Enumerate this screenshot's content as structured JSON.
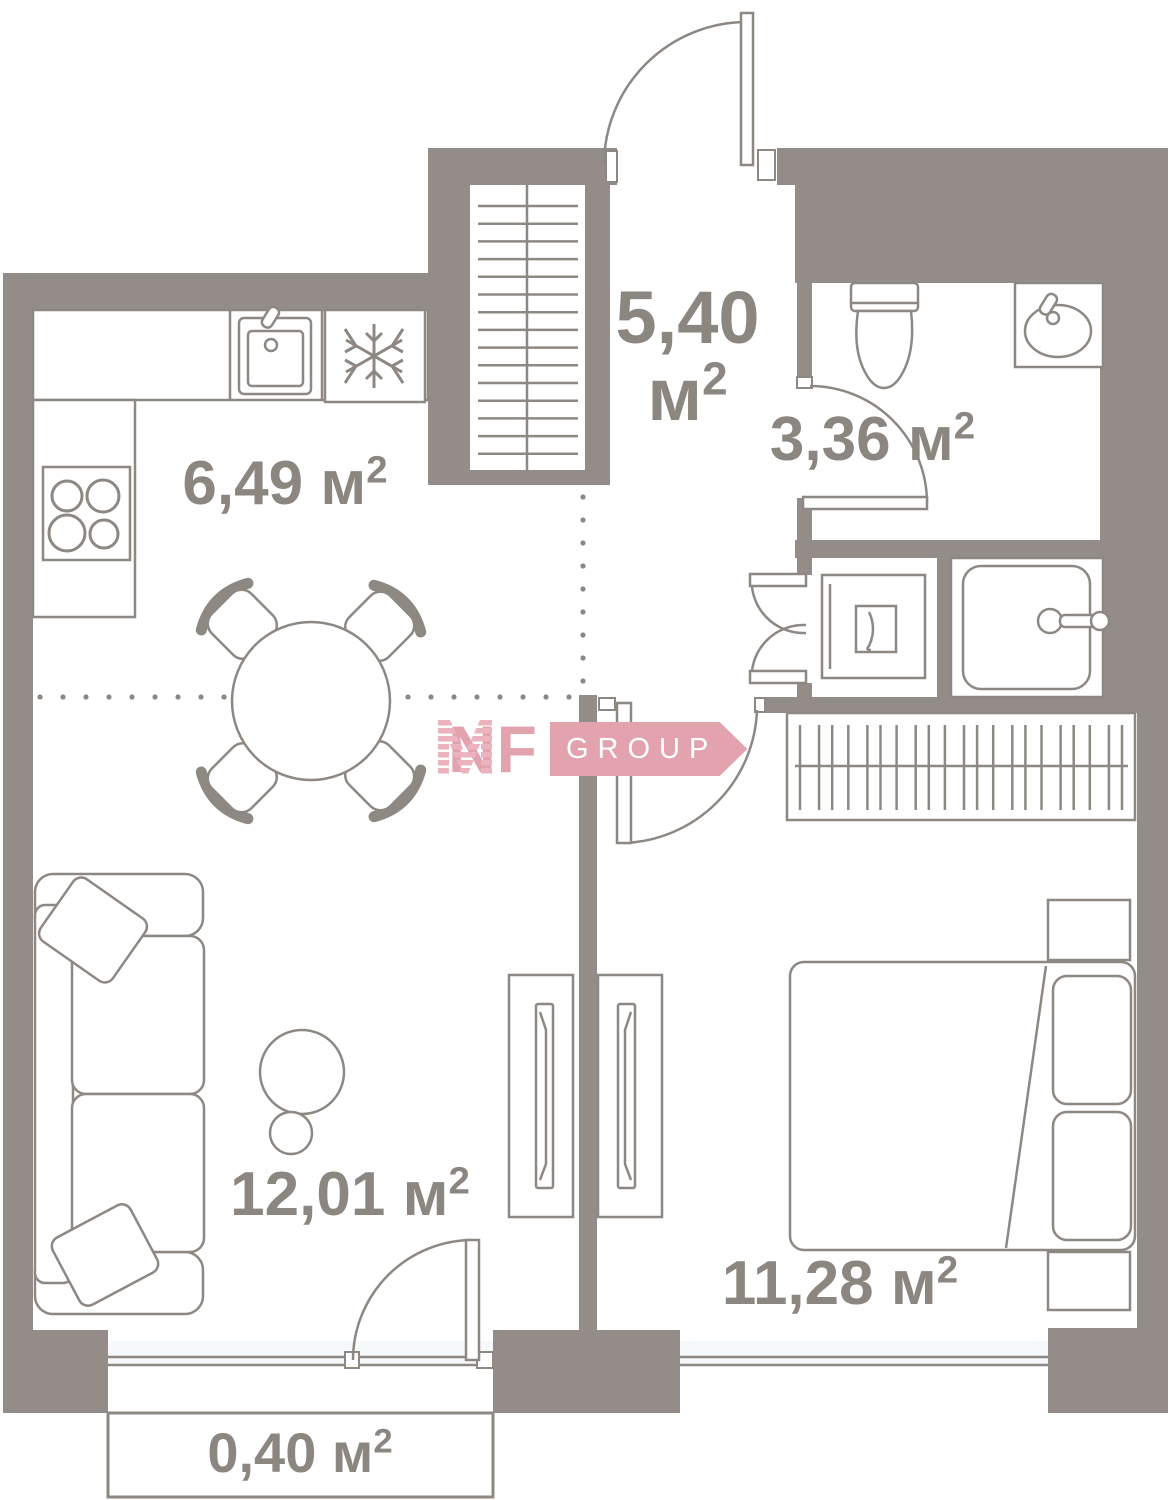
{
  "canvas": {
    "width": 1173,
    "height": 1500
  },
  "colors": {
    "wall": "#938c88",
    "line": "#8e8883",
    "text": "#8c8680",
    "logo_pink": "#e2a2ae",
    "logo_banner": "#e2a3af",
    "window_glass": "#f6f9fb"
  },
  "rooms": {
    "kitchen": {
      "area": "6,49",
      "unit": "м",
      "sup": "2"
    },
    "hallway": {
      "area": "5,40",
      "unit": "м",
      "sup": "2"
    },
    "bathroom": {
      "area": "3,36",
      "unit": "м",
      "sup": "2"
    },
    "living": {
      "area": "12,01",
      "unit": "м",
      "sup": "2"
    },
    "bedroom": {
      "area": "11,28",
      "unit": "м",
      "sup": "2"
    },
    "balcony": {
      "area": "0,40",
      "unit": "м",
      "sup": "2"
    }
  },
  "logo": {
    "nf": "NF",
    "group": "GROUP"
  },
  "icons": {
    "fridge": "snowflake-icon",
    "stove": "four-burner-hob-icon",
    "kitchen_sink": "sink-square-icon",
    "toilet": "toilet-icon",
    "wash_basin": "basin-oval-icon",
    "shower": "shower-tray-icon",
    "washing_machine": "washing-machine-icon",
    "stairs": "stair-flight-icon",
    "wardrobe": "hanging-rail-icon"
  }
}
